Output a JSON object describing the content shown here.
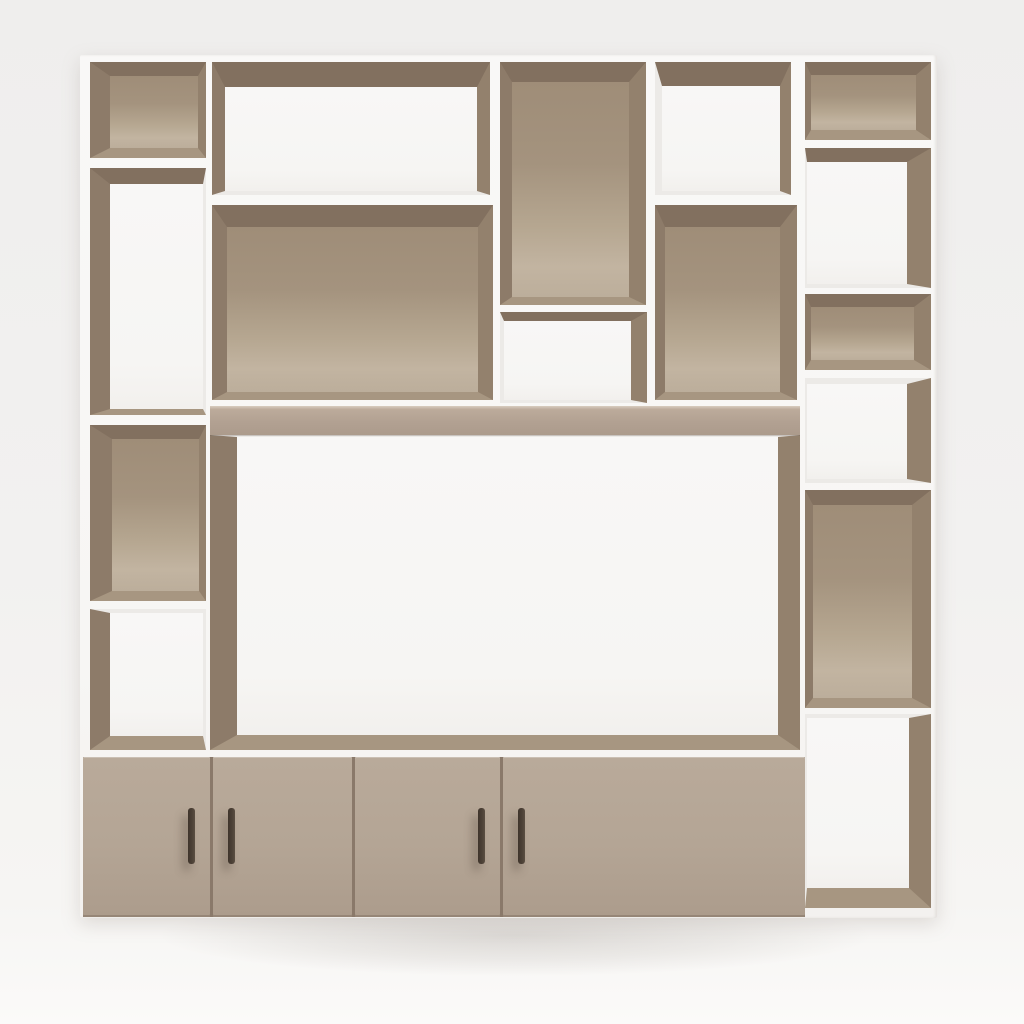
{
  "scene": {
    "description": "3D render of a modern wall shelving unit with open compartments, a central TV niche and four lower cabinet doors, in taupe and white",
    "palette": {
      "background_top": "#efeeed",
      "background_floor": "#fbfaf9",
      "frame_white": "#f8f7f5",
      "frame_shade": "#eceae7",
      "bevel_top": "#82705f",
      "bevel_left": "#8d7b69",
      "bevel_right": "#93816d",
      "bevel_bottom": "#a79681",
      "back_taupe": "#a89780",
      "back_taupe_highlight": "#c2b4a1",
      "back_white": "#f7f6f4",
      "shelf_band": "#b2a192",
      "door": "#b4a595",
      "door_gap": "#8a796a",
      "handle": "#4b4036",
      "floor_shadow": "rgba(120,110,100,0.22)"
    },
    "unit": {
      "x": 80,
      "y": 55,
      "w": 857,
      "h": 863
    },
    "compartments": [
      {
        "id": "left-1",
        "x": 90,
        "y": 62,
        "w": 116,
        "h": 96,
        "back": "taupe",
        "t": [
          14,
          "top"
        ],
        "r": [
          8,
          "right"
        ],
        "b": [
          10,
          "bottom"
        ],
        "l": [
          20,
          "left"
        ]
      },
      {
        "id": "left-2",
        "x": 90,
        "y": 168,
        "w": 116,
        "h": 247,
        "back": "white",
        "t": [
          16,
          "top"
        ],
        "r": [
          3,
          "frame"
        ],
        "b": [
          6,
          "bottom"
        ],
        "l": [
          20,
          "left"
        ]
      },
      {
        "id": "left-3",
        "x": 90,
        "y": 425,
        "w": 116,
        "h": 176,
        "back": "taupe",
        "t": [
          14,
          "top"
        ],
        "r": [
          7,
          "right"
        ],
        "b": [
          10,
          "bottom"
        ],
        "l": [
          22,
          "left"
        ]
      },
      {
        "id": "left-4",
        "x": 90,
        "y": 609,
        "w": 116,
        "h": 141,
        "back": "white",
        "t": [
          4,
          "frame"
        ],
        "r": [
          3,
          "frame"
        ],
        "b": [
          14,
          "bottom"
        ],
        "l": [
          20,
          "left"
        ]
      },
      {
        "id": "midleft-top",
        "x": 212,
        "y": 62,
        "w": 278,
        "h": 133,
        "back": "white",
        "t": [
          25,
          "top"
        ],
        "r": [
          13,
          "right"
        ],
        "b": [
          4,
          "frame"
        ],
        "l": [
          13,
          "left"
        ]
      },
      {
        "id": "midleft-main",
        "x": 212,
        "y": 205,
        "w": 281,
        "h": 195,
        "back": "taupe",
        "t": [
          22,
          "top"
        ],
        "r": [
          15,
          "right"
        ],
        "b": [
          8,
          "bottom"
        ],
        "l": [
          15,
          "left"
        ]
      },
      {
        "id": "mid-top",
        "x": 500,
        "y": 62,
        "w": 146,
        "h": 243,
        "back": "taupe",
        "t": [
          20,
          "top"
        ],
        "r": [
          17,
          "right"
        ],
        "b": [
          8,
          "bottom"
        ],
        "l": [
          12,
          "left"
        ]
      },
      {
        "id": "mid-small",
        "x": 500,
        "y": 312,
        "w": 147,
        "h": 91,
        "back": "white",
        "t": [
          9,
          "top"
        ],
        "r": [
          16,
          "right"
        ],
        "b": [
          3,
          "frame"
        ],
        "l": [
          4,
          "frame"
        ]
      },
      {
        "id": "midright-top",
        "x": 655,
        "y": 62,
        "w": 136,
        "h": 133,
        "back": "white",
        "t": [
          24,
          "top"
        ],
        "r": [
          11,
          "right"
        ],
        "b": [
          4,
          "frame"
        ],
        "l": [
          7,
          "frame"
        ]
      },
      {
        "id": "midright-main",
        "x": 655,
        "y": 205,
        "w": 142,
        "h": 195,
        "back": "taupe",
        "t": [
          22,
          "top"
        ],
        "r": [
          17,
          "right"
        ],
        "b": [
          8,
          "bottom"
        ],
        "l": [
          10,
          "left"
        ]
      },
      {
        "id": "right-1",
        "x": 805,
        "y": 62,
        "w": 126,
        "h": 78,
        "back": "taupe",
        "t": [
          13,
          "top"
        ],
        "r": [
          15,
          "right"
        ],
        "b": [
          10,
          "bottom"
        ],
        "l": [
          6,
          "left"
        ]
      },
      {
        "id": "right-2",
        "x": 805,
        "y": 148,
        "w": 126,
        "h": 140,
        "back": "white",
        "t": [
          14,
          "top"
        ],
        "r": [
          24,
          "right"
        ],
        "b": [
          4,
          "frame"
        ],
        "l": [
          2,
          "frame"
        ]
      },
      {
        "id": "right-3",
        "x": 805,
        "y": 294,
        "w": 126,
        "h": 76,
        "back": "taupe",
        "t": [
          13,
          "top"
        ],
        "r": [
          17,
          "right"
        ],
        "b": [
          10,
          "bottom"
        ],
        "l": [
          6,
          "left"
        ]
      },
      {
        "id": "right-4",
        "x": 805,
        "y": 378,
        "w": 126,
        "h": 105,
        "back": "white",
        "t": [
          6,
          "frame"
        ],
        "r": [
          24,
          "right"
        ],
        "b": [
          4,
          "frame"
        ],
        "l": [
          2,
          "frame"
        ]
      },
      {
        "id": "right-5",
        "x": 805,
        "y": 490,
        "w": 126,
        "h": 218,
        "back": "taupe",
        "t": [
          15,
          "top"
        ],
        "r": [
          19,
          "right"
        ],
        "b": [
          10,
          "bottom"
        ],
        "l": [
          8,
          "left"
        ]
      },
      {
        "id": "right-6",
        "x": 805,
        "y": 714,
        "w": 126,
        "h": 194,
        "back": "white",
        "t": [
          4,
          "frame"
        ],
        "r": [
          22,
          "right"
        ],
        "b": [
          20,
          "bottom"
        ],
        "l": [
          2,
          "frame"
        ]
      },
      {
        "id": "tv-niche",
        "x": 210,
        "y": 435,
        "w": 590,
        "h": 315,
        "back": "white",
        "t": [
          2,
          "frame"
        ],
        "r": [
          22,
          "right"
        ],
        "b": [
          15,
          "bottom"
        ],
        "l": [
          27,
          "left"
        ]
      }
    ],
    "shelf_band": {
      "x": 210,
      "y": 406,
      "w": 590,
      "h": 29
    },
    "cabinet": {
      "x": 83,
      "y": 757,
      "w": 722,
      "h": 160,
      "doors": [
        {
          "id": "door-1",
          "x": 83,
          "w": 127,
          "handle_side": "right"
        },
        {
          "id": "door-2",
          "x": 213,
          "w": 139,
          "handle_side": "left"
        },
        {
          "id": "door-3",
          "x": 355,
          "w": 145,
          "handle_side": "right"
        },
        {
          "id": "door-4",
          "x": 503,
          "w": 302,
          "handle_side": "left"
        }
      ],
      "handle": {
        "w": 7,
        "h": 56,
        "top": 51,
        "inset": 15
      }
    },
    "floor_shadow_rect": {
      "x": 40,
      "y": 880,
      "w": 950,
      "h": 110
    }
  }
}
